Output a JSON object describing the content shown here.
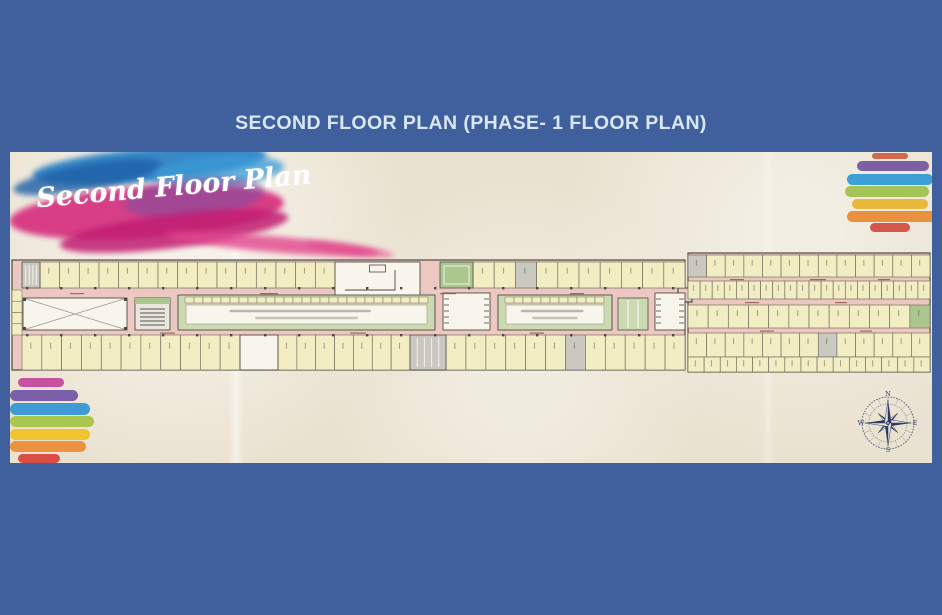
{
  "window": {
    "background": "#40609d"
  },
  "title": {
    "text": "SECOND FLOOR PLAN (PHASE- 1 FLOOR PLAN)",
    "color": "#d9e7f4"
  },
  "plan_image": {
    "script_label": "Second Floor Plan",
    "paper_color": "#eae2d0",
    "watercolor_colors": {
      "blue": "#2f83c5",
      "deep_blue": "#1d5fa6",
      "sky_blue": "#3a9bd8",
      "magenta": "#d5307f",
      "purple": "#7a4ea0",
      "crimson": "#c11d72",
      "pink": "#e2458d"
    },
    "rainbow_top_right": [
      "#cf6a4e",
      "#7c5fa5",
      "#3e9ed6",
      "#a4c457",
      "#e9b83c",
      "#e9913f",
      "#d4574c"
    ],
    "rainbow_bottom_left": [
      "#c750a0",
      "#7b5fa8",
      "#3f9bd4",
      "#a9c74f",
      "#f0c32f",
      "#ec9340",
      "#d94f47"
    ],
    "compass": {
      "color": "#2c3a66",
      "labels": {
        "north": "N",
        "east": "E",
        "south": "S",
        "west": "W"
      }
    }
  },
  "plan_colors": {
    "corridor": "#edc8c2",
    "shop": "#f3edc4",
    "shop_border": "#72725f",
    "outline": "#4d4d43",
    "atrium": "#f8f5ec",
    "line_grey": "#9b9b8d",
    "green": "#abc78f",
    "light_green": "#ccdab2",
    "grey": "#c9c9c1",
    "dark": "#4a4a42",
    "label_red": "#8f564f",
    "tread_white": "#f2f0ea"
  },
  "plan_geometry": {
    "svg": {
      "w": 922,
      "h": 311
    },
    "wings": [
      {
        "name": "left-wing",
        "x": 2,
        "y": 108,
        "w": 673,
        "h": 110
      },
      {
        "name": "right-wing",
        "x": 678,
        "y": 101,
        "w": 242,
        "h": 119
      },
      {
        "name": "connector",
        "x": 668,
        "y": 136,
        "w": 14,
        "h": 14
      }
    ],
    "shop_bands": [
      {
        "x": 30,
        "y": 110,
        "w": 295,
        "h": 26,
        "n": 15,
        "grey": [],
        "green": []
      },
      {
        "x": 463,
        "y": 110,
        "w": 212,
        "h": 26,
        "n": 10,
        "grey": [
          2
        ],
        "green": []
      },
      {
        "x": 12,
        "y": 183,
        "w": 218,
        "h": 35,
        "n": 11,
        "grey": [],
        "green": []
      },
      {
        "x": 268,
        "y": 183,
        "w": 132,
        "h": 35,
        "n": 7,
        "grey": [],
        "green": []
      },
      {
        "x": 436,
        "y": 183,
        "w": 239,
        "h": 35,
        "n": 12,
        "grey": [
          6
        ],
        "green": []
      },
      {
        "x": 678,
        "y": 103,
        "w": 242,
        "h": 22,
        "n": 13,
        "grey": [
          0
        ],
        "green": []
      },
      {
        "x": 678,
        "y": 129,
        "w": 242,
        "h": 18,
        "n": 20,
        "grey": [],
        "green": []
      },
      {
        "x": 678,
        "y": 153,
        "w": 242,
        "h": 23,
        "n": 12,
        "grey": [],
        "green": [
          11
        ]
      },
      {
        "x": 678,
        "y": 181,
        "w": 242,
        "h": 24,
        "n": 13,
        "grey": [
          7
        ],
        "green": []
      },
      {
        "x": 678,
        "y": 205,
        "w": 242,
        "h": 15,
        "n": 15,
        "grey": [],
        "green": []
      }
    ],
    "blocks": [
      {
        "type": "stair",
        "x": 12,
        "y": 110,
        "w": 18,
        "h": 26
      },
      {
        "type": "lroom",
        "x": 325,
        "y": 110,
        "w": 85,
        "h": 38
      },
      {
        "type": "lift",
        "x": 430,
        "y": 110,
        "w": 33,
        "h": 26
      },
      {
        "type": "vshops",
        "x": 2,
        "y": 138,
        "w": 10,
        "h": 45
      },
      {
        "type": "atrium_x",
        "x": 13,
        "y": 146,
        "w": 104,
        "h": 32
      },
      {
        "type": "escalator",
        "x": 125,
        "y": 146,
        "w": 35,
        "h": 32
      },
      {
        "type": "foodcourt",
        "x": 168,
        "y": 143,
        "w": 257,
        "h": 35
      },
      {
        "type": "atrium_t",
        "x": 433,
        "y": 141,
        "w": 47,
        "h": 37
      },
      {
        "type": "foodcourt",
        "x": 488,
        "y": 143,
        "w": 114,
        "h": 35
      },
      {
        "type": "greencols",
        "x": 608,
        "y": 146,
        "w": 30,
        "h": 32
      },
      {
        "type": "atrium_t",
        "x": 645,
        "y": 141,
        "w": 30,
        "h": 37
      },
      {
        "type": "lobby",
        "x": 230,
        "y": 183,
        "w": 38,
        "h": 35
      },
      {
        "type": "stair",
        "x": 400,
        "y": 183,
        "w": 36,
        "h": 35
      }
    ],
    "label_dashes": [
      [
        60,
        141,
        14
      ],
      [
        250,
        141,
        18
      ],
      [
        430,
        141,
        16
      ],
      [
        560,
        141,
        14
      ],
      [
        150,
        180.5,
        15
      ],
      [
        340,
        180.5,
        16
      ],
      [
        520,
        180.5,
        14
      ],
      [
        720,
        127,
        14
      ],
      [
        800,
        127,
        16
      ],
      [
        868,
        127,
        12
      ],
      [
        735,
        150,
        14
      ],
      [
        825,
        150,
        12
      ],
      [
        750,
        178.5,
        14
      ],
      [
        850,
        178.5,
        12
      ]
    ],
    "column_ticks": {
      "y1": 135,
      "y2": 182,
      "x_start": 16,
      "x_end": 668,
      "step": 34
    }
  },
  "rainbow_geometry": {
    "top_right": [
      [
        862,
        1,
        36,
        6
      ],
      [
        847,
        9,
        72,
        10
      ],
      [
        837,
        22,
        86,
        11
      ],
      [
        835,
        34,
        84,
        11
      ],
      [
        842,
        47,
        76,
        10
      ],
      [
        837,
        59,
        92,
        11
      ],
      [
        860,
        71,
        40,
        9
      ]
    ],
    "bottom_left": [
      [
        8,
        226,
        46,
        9
      ],
      [
        0,
        238,
        68,
        11
      ],
      [
        0,
        251,
        80,
        12
      ],
      [
        0,
        264,
        84,
        11
      ],
      [
        0,
        277,
        80,
        11
      ],
      [
        0,
        289,
        76,
        11
      ],
      [
        8,
        302,
        42,
        9
      ]
    ]
  },
  "watercolor_strokes": [
    {
      "x": 28,
      "y": 0,
      "w": 235,
      "h": 34,
      "rot": -5,
      "color": "blue",
      "op": 0.95
    },
    {
      "x": 8,
      "y": 16,
      "w": 150,
      "h": 26,
      "rot": -10,
      "color": "deep_blue",
      "op": 0.8
    },
    {
      "x": 150,
      "y": 8,
      "w": 130,
      "h": 30,
      "rot": -4,
      "color": "sky_blue",
      "op": 0.75
    },
    {
      "x": 5,
      "y": 38,
      "w": 275,
      "h": 52,
      "rot": -4,
      "color": "magenta",
      "op": 0.92
    },
    {
      "x": 120,
      "y": 30,
      "w": 140,
      "h": 40,
      "rot": -6,
      "color": "purple",
      "op": 0.55
    },
    {
      "x": 55,
      "y": 66,
      "w": 230,
      "h": 34,
      "rot": -7,
      "color": "crimson",
      "op": 0.85
    },
    {
      "x": 160,
      "y": 88,
      "w": 215,
      "h": 16,
      "rot": 5,
      "color": "pink",
      "op": 0.8
    },
    {
      "x": 300,
      "y": 96,
      "w": 90,
      "h": 10,
      "rot": 8,
      "color": "pink",
      "op": 0.65
    }
  ]
}
